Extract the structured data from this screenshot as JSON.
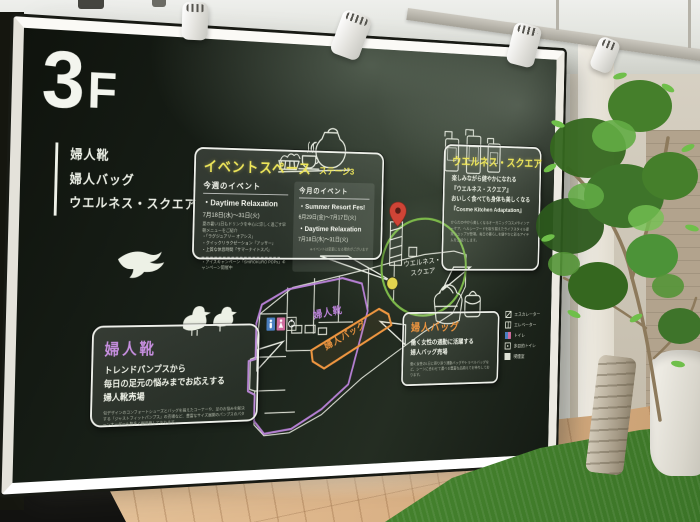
{
  "floor": {
    "big": "3",
    "small": "F"
  },
  "directory": {
    "items": [
      "婦人靴",
      "婦人バッグ",
      "ウエルネス・スクエア"
    ]
  },
  "event": {
    "title": "イベントスペース",
    "stage": "ステージ3",
    "weekly": {
      "heading": "今週のイベント",
      "name": "・Daytime Relaxation",
      "dates": "7月18日(水)〜31日(火)",
      "desc": "夏の暑い1日もドリンクを中心に涼しく過ごす早朝メニューをご紹介",
      "bullets": [
        "・「ラグジュアリー オアシス」",
        "・クイックリラクゼーション「アッサー」",
        "・上質な休息時間「サマーナイトスパ」"
      ],
      "campaign": "・アイスキャンペーン「SHiROKURO POPs」キャンペーン開催中"
    },
    "monthly": {
      "heading": "今月のイベント",
      "items": [
        {
          "name": "・Summer Resort Fes!",
          "dates": "6月29日(金)〜7月17日(火)"
        },
        {
          "name": "・Daytime Relaxation",
          "dates": "7月18日(水)〜31日(火)"
        }
      ],
      "note": "※イベントは変更になる場合がございます"
    }
  },
  "wellness": {
    "title": "ウエルネス・スクエア",
    "lines": [
      "楽しみながら健やかになれる",
      "『ウエルネス・スクエア』",
      "おいしく食べても身体も美しくなる",
      "『Cosme Kitchen Adaptation』"
    ],
    "desc": "からだの中から美しくなるオーガニックコスメやインナーケア、ヘルシーフードを取り揃えたライフスタイル提案ショップが登場。毎日の暮らしを健やかに彩るアイテムをご紹介します。"
  },
  "shoes": {
    "title": "婦人靴",
    "lines": [
      "トレンドパンプスから",
      "毎日の足元の悩みまでお応えする",
      "婦人靴売場"
    ],
    "desc": "旬デザインのコンフォートシューズとバッグを揃えたコーナーや、足のお悩みを解決する「ジャストフィットパンプス」の売場など、豊富なサイズ展開のパンプスのパターンオーダーも数多く御用意しております。"
  },
  "bag": {
    "title": "婦人バッグ",
    "lines": [
      "働く女性の通勤に活躍する",
      "婦人バッグ売場"
    ],
    "desc": "働く女性の1日に寄り添う通勤バッグやトラベルバッグなど、シーンに合わせて選べる豊富な品揃えでお待ちしております。"
  },
  "map": {
    "labels": {
      "shoes": "婦人靴",
      "bag": "婦人バッグ",
      "wellness1": "ウエルネス・",
      "wellness2": "スクエア"
    }
  },
  "legend": {
    "items": [
      "エスカレーター",
      "エレベーター",
      "トイレ",
      "多目的トイレ",
      "喫煙室"
    ]
  },
  "colors": {
    "accent_yellow": "#efe75a",
    "zone_purple": "#bd84dc",
    "zone_orange": "#ef9640",
    "highlight_green": "#7cb84a",
    "chalk_white": "#eef2e8"
  }
}
